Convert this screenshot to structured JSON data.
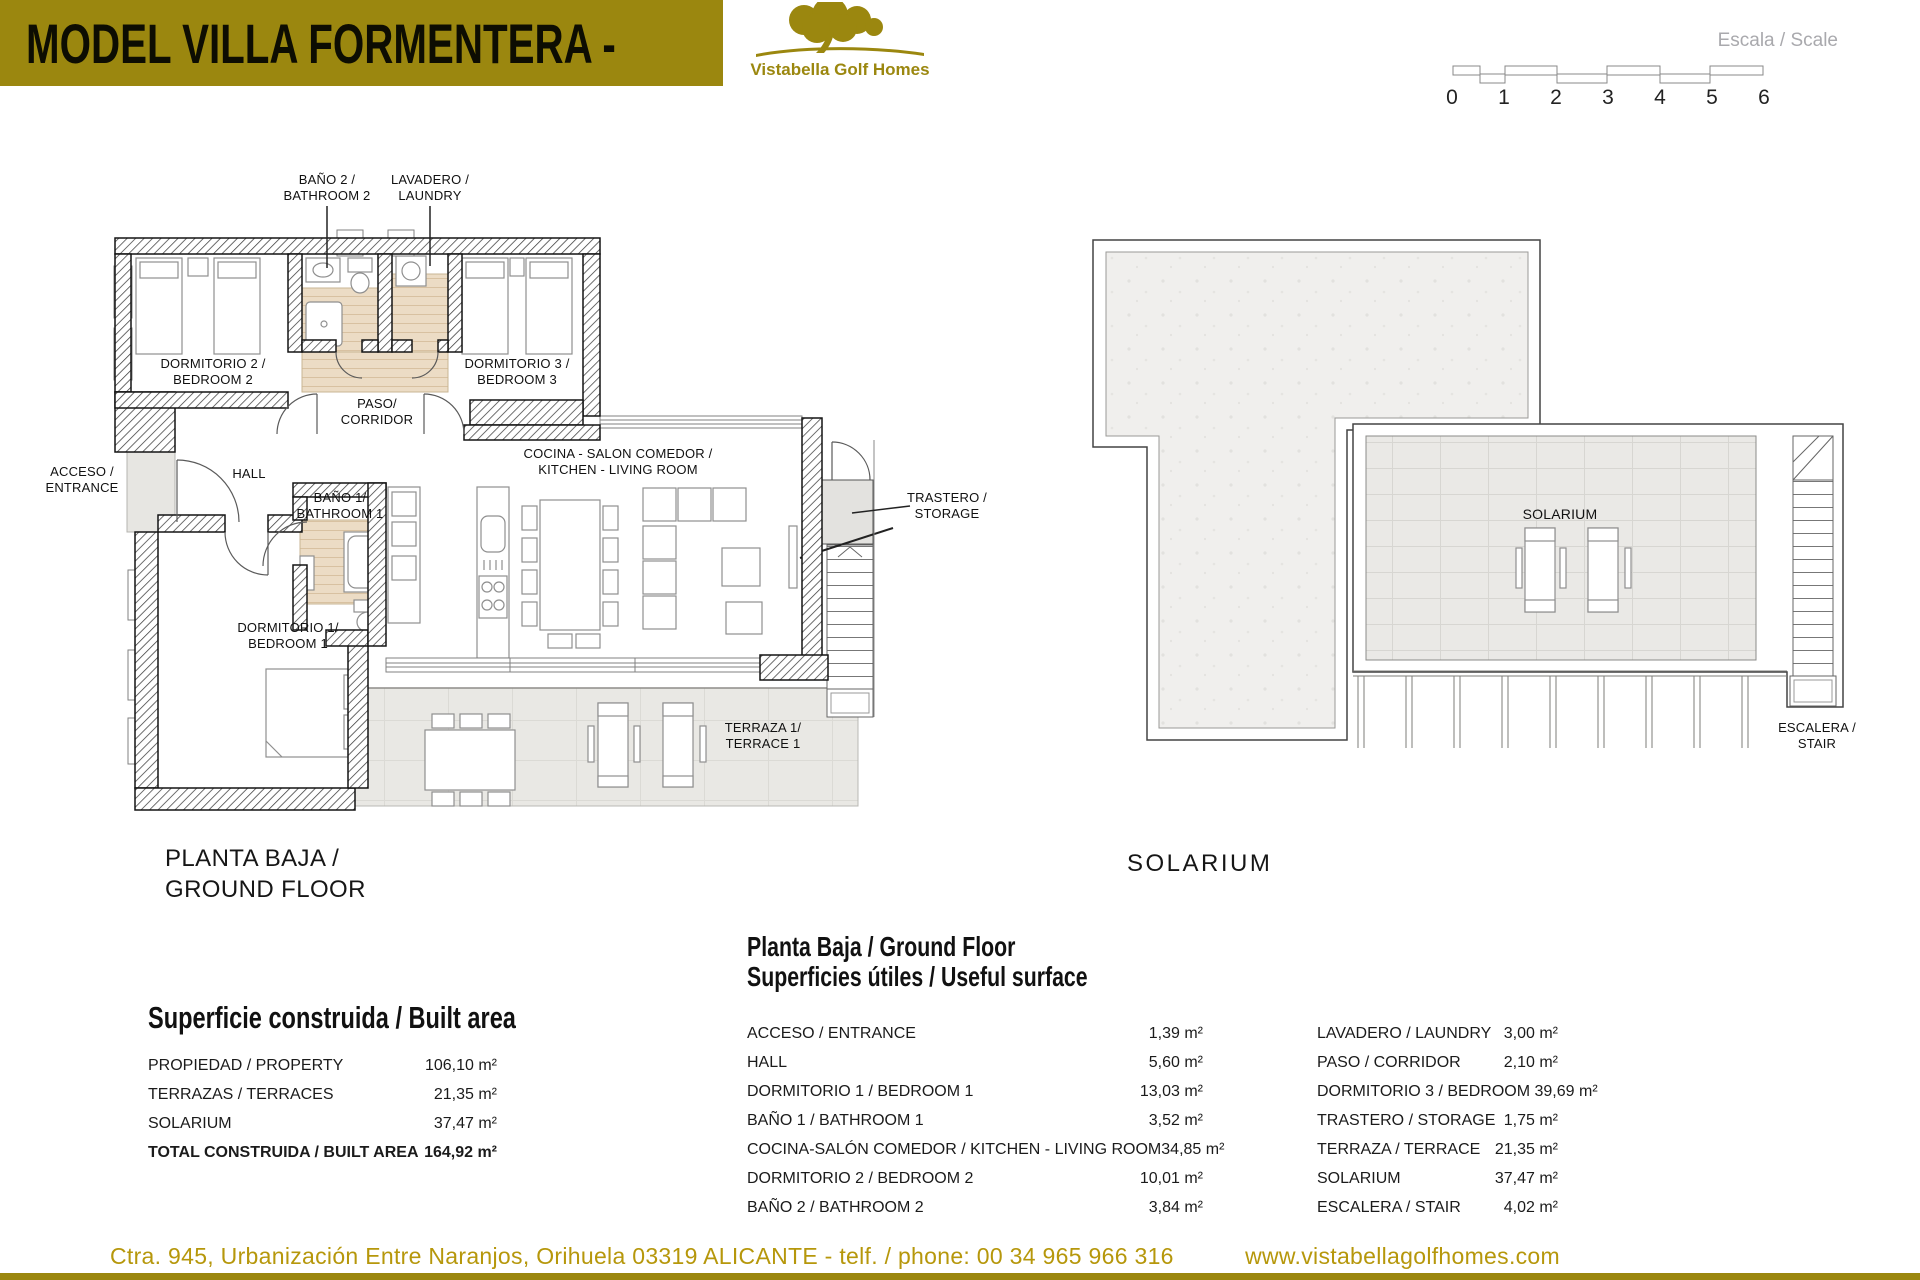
{
  "header": {
    "title_black": "MODEL VILLA  FORMENTERA - ",
    "title_white": "3 Bedrooms",
    "brand": "Vistabella Golf Homes",
    "banner_color": "#9b870f"
  },
  "scale": {
    "label": "Escala / Scale",
    "ticks": [
      "0",
      "1",
      "2",
      "3",
      "4",
      "5",
      "6"
    ]
  },
  "ground_floor": {
    "title": "PLANTA BAJA /\nGROUND FLOOR",
    "labels": {
      "bano2": "BAÑO 2 /\nBATHROOM 2",
      "lavadero": "LAVADERO /\nLAUNDRY",
      "dorm2": "DORMITORIO 2 /\nBEDROOM 2",
      "dorm3": "DORMITORIO 3 /\nBEDROOM 3",
      "paso": "PASO/\nCORRIDOR",
      "acceso": "ACCESO /\nENTRANCE",
      "hall": "HALL",
      "bano1": "BAÑO 1/\nBATHROOM 1",
      "cocina": "COCINA - SALON COMEDOR /\nKITCHEN - LIVING ROOM",
      "trastero": "TRASTERO /\nSTORAGE",
      "dorm1": "DORMITORIO 1/\nBEDROOM 1",
      "terraza": "TERRAZA 1/\nTERRACE 1"
    }
  },
  "solarium_plan": {
    "title": "SOLARIUM",
    "labels": {
      "solarium": "SOLARIUM",
      "escalera": "ESCALERA /\nSTAIR"
    }
  },
  "built_area": {
    "title": "Superficie construida / Built area",
    "rows": [
      {
        "label": "PROPIEDAD / PROPERTY",
        "value": "106,10 m²"
      },
      {
        "label": "TERRAZAS / TERRACES",
        "value": "21,35 m²"
      },
      {
        "label": "SOLARIUM",
        "value": "37,47 m²"
      },
      {
        "label": "TOTAL CONSTRUIDA / BUILT AREA",
        "value": "164,92 m²",
        "bold": true
      }
    ]
  },
  "useful_surface": {
    "title_line1": "Planta Baja / Ground Floor",
    "title_line2": "Superficies útiles / Useful surface",
    "left_rows": [
      {
        "label": "ACCESO / ENTRANCE",
        "value": "1,39 m²"
      },
      {
        "label": "HALL",
        "value": "5,60 m²"
      },
      {
        "label": "DORMITORIO 1 / BEDROOM 1",
        "value": "13,03 m²"
      },
      {
        "label": "BAÑO 1 / BATHROOM 1",
        "value": "3,52 m²"
      },
      {
        "label": "COCINA-SALÓN COMEDOR / KITCHEN - LIVING ROOM",
        "value": "34,85 m²"
      },
      {
        "label": "DORMITORIO 2 / BEDROOM 2",
        "value": "10,01 m²"
      },
      {
        "label": "BAÑO 2 / BATHROOM 2",
        "value": "3,84 m²"
      }
    ],
    "right_rows": [
      {
        "label": "LAVADERO / LAUNDRY",
        "value": "3,00 m²"
      },
      {
        "label": "PASO / CORRIDOR",
        "value": "2,10 m²"
      },
      {
        "label": "DORMITORIO 3 / BEDROOM 3",
        "value": "9,69 m²"
      },
      {
        "label": "TRASTERO / STORAGE",
        "value": "1,75 m²"
      },
      {
        "label": "TERRAZA  / TERRACE",
        "value": "21,35 m²"
      },
      {
        "label": "SOLARIUM",
        "value": "37,47 m²"
      },
      {
        "label": "ESCALERA / STAIR",
        "value": "4,02 m²"
      }
    ]
  },
  "footer": {
    "address": "Ctra. 945, Urbanización Entre Naranjos, Orihuela 03319 ALICANTE - telf. / phone: 00 34 965 966 316",
    "website": "www.vistabellagolfhomes.com",
    "color": "#b6970b"
  }
}
